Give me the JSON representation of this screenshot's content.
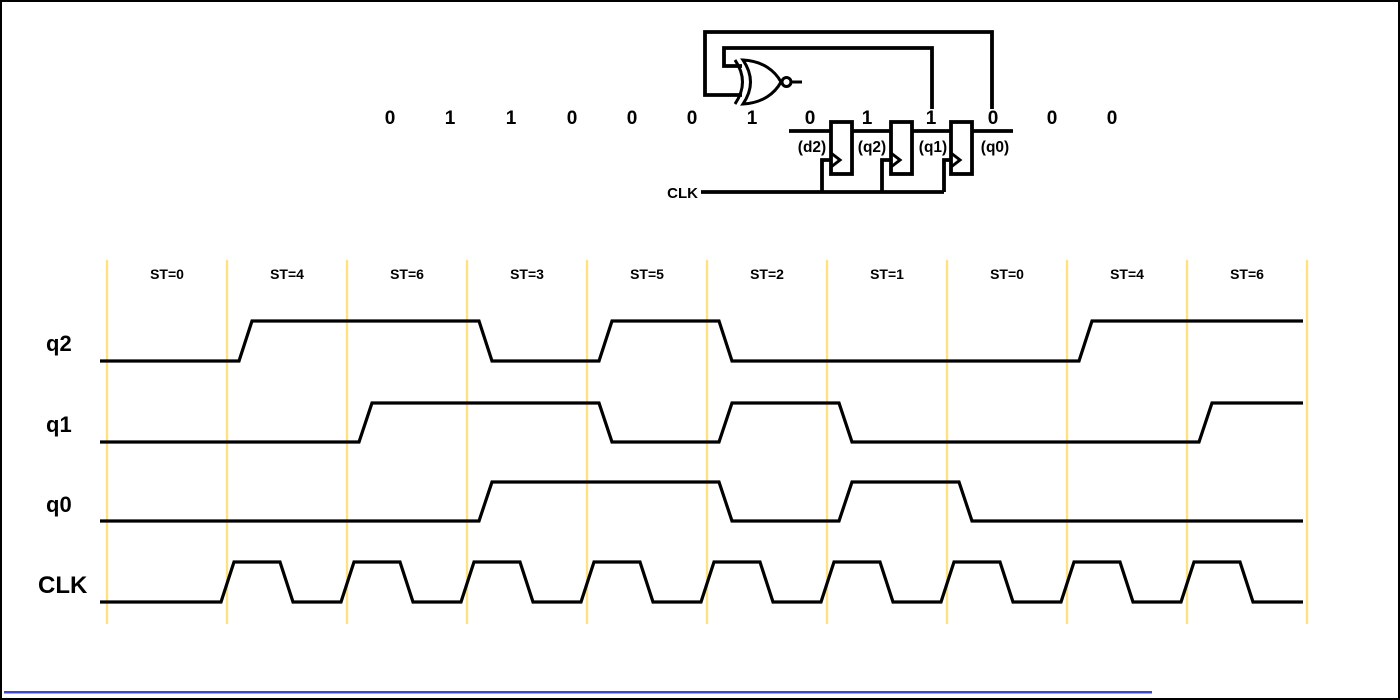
{
  "circuit": {
    "clk_label": "CLK",
    "gate": "xnor-gate",
    "bit_stream": [
      "0",
      "1",
      "1",
      "0",
      "0",
      "0",
      "1",
      "0",
      "1",
      "1",
      "0",
      "0",
      "0"
    ],
    "register_labels": [
      "(d2)",
      "(q2)",
      "(q1)",
      "(q0)"
    ]
  },
  "timing": {
    "state_labels": [
      "ST=0",
      "ST=4",
      "ST=6",
      "ST=3",
      "ST=5",
      "ST=2",
      "ST=1",
      "ST=0",
      "ST=4",
      "ST=6"
    ],
    "signals": [
      {
        "name": "q2",
        "bits": [
          0,
          1,
          1,
          0,
          1,
          0,
          0,
          0,
          1,
          1
        ]
      },
      {
        "name": "q1",
        "bits": [
          0,
          0,
          1,
          1,
          0,
          1,
          0,
          0,
          0,
          1
        ]
      },
      {
        "name": "q0",
        "bits": [
          0,
          0,
          0,
          1,
          1,
          0,
          1,
          0,
          0,
          0
        ]
      },
      {
        "name": "CLK",
        "clock": true,
        "pulses": 9
      }
    ]
  },
  "colors": {
    "line": "#000000",
    "gridline": "#ffe082",
    "bottom_accent": "#3f48cc",
    "background": "#ffffff"
  }
}
